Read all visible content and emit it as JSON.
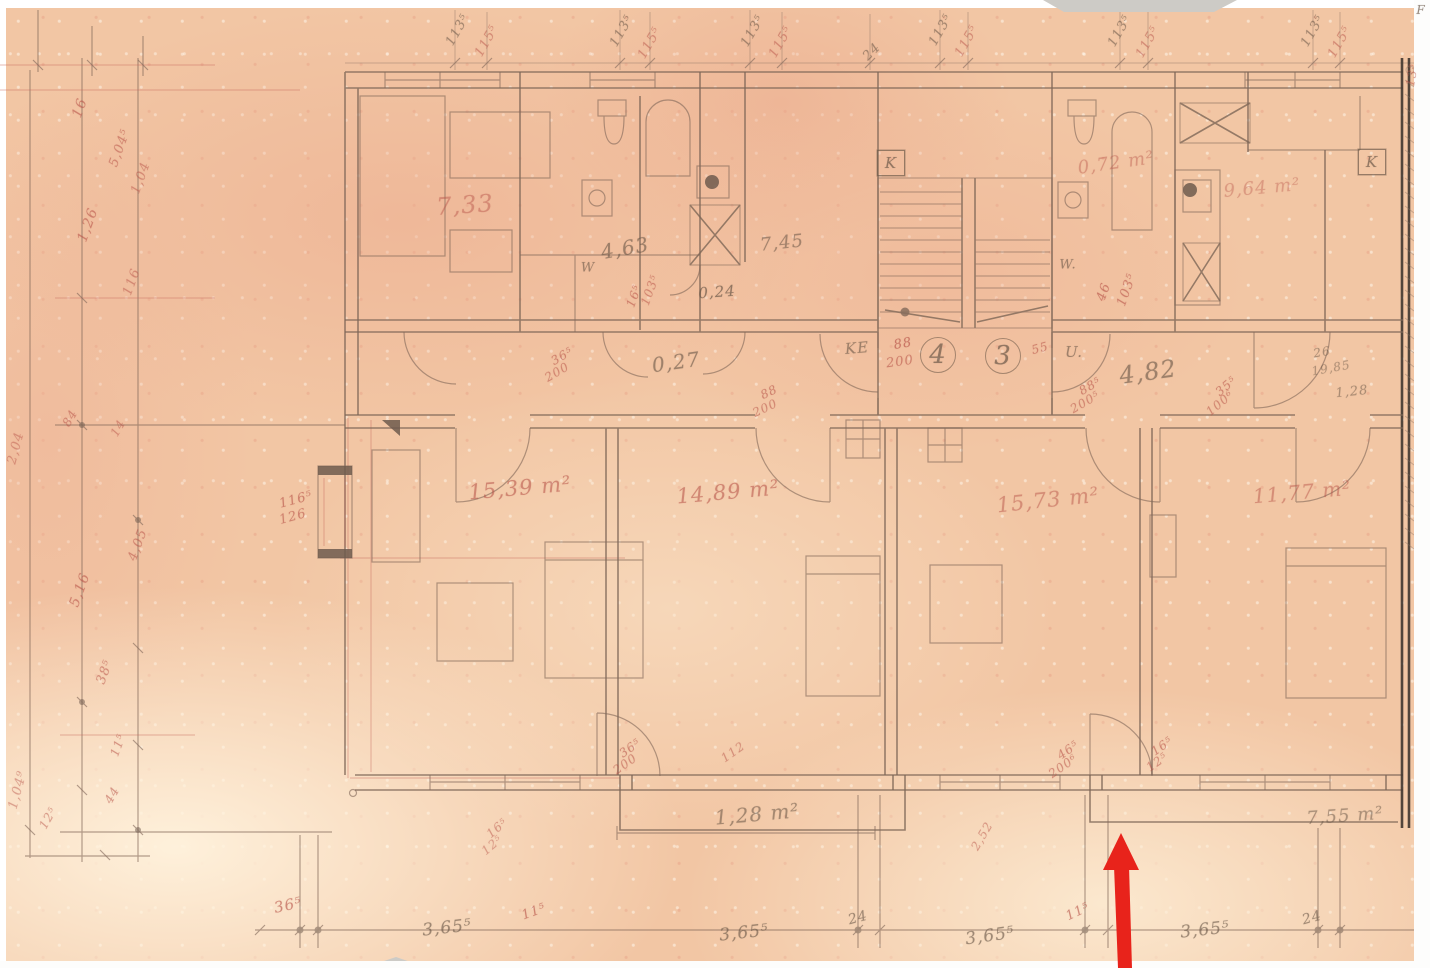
{
  "meta": {
    "kind": "scanned hand-drawn architectural floor plan",
    "paper_color": "#f2c6a4",
    "pencil_color": "#7e6757",
    "red_pencil_color": "#c05f55",
    "arrow_color": "#e8231b"
  },
  "annotations": [
    {
      "name": "room-area",
      "text": "7,33",
      "x": 465,
      "y": 205,
      "rot": -4,
      "size": 24,
      "color": "red",
      "opacity": 0.55
    },
    {
      "name": "room-area",
      "text": "0,72 m²",
      "x": 1116,
      "y": 163,
      "rot": -8,
      "size": 18,
      "color": "red",
      "opacity": 0.5
    },
    {
      "name": "room-area",
      "text": "9,64 m²",
      "x": 1262,
      "y": 188,
      "rot": -5,
      "size": 18,
      "color": "red",
      "opacity": 0.45
    },
    {
      "name": "room-area",
      "text": "4,63",
      "x": 625,
      "y": 248,
      "rot": -10,
      "size": 20,
      "color": "pencil",
      "opacity": 0.7
    },
    {
      "name": "room-area",
      "text": "7,45",
      "x": 782,
      "y": 243,
      "rot": -6,
      "size": 18,
      "color": "pencil",
      "opacity": 0.65
    },
    {
      "name": "room-area",
      "text": "0,24",
      "x": 717,
      "y": 292,
      "rot": -4,
      "size": 15,
      "color": "pencil",
      "opacity": 0.8
    },
    {
      "name": "room-area",
      "text": "0,27",
      "x": 676,
      "y": 362,
      "rot": -8,
      "size": 20,
      "color": "pencil",
      "opacity": 0.7
    },
    {
      "name": "room-area",
      "text": "15,39 m²",
      "x": 520,
      "y": 488,
      "rot": -5,
      "size": 21,
      "color": "red",
      "opacity": 0.68
    },
    {
      "name": "room-area",
      "text": "14,89 m²",
      "x": 728,
      "y": 492,
      "rot": -5,
      "size": 21,
      "color": "red",
      "opacity": 0.68
    },
    {
      "name": "room-area",
      "text": "15,73 m²",
      "x": 1048,
      "y": 500,
      "rot": -6,
      "size": 21,
      "color": "red",
      "opacity": 0.58
    },
    {
      "name": "room-area",
      "text": "11,77 m²",
      "x": 1302,
      "y": 492,
      "rot": -5,
      "size": 20,
      "color": "red",
      "opacity": 0.58
    },
    {
      "name": "room-area",
      "text": "1,28 m²",
      "x": 757,
      "y": 814,
      "rot": -5,
      "size": 20,
      "color": "pencil",
      "opacity": 0.66
    },
    {
      "name": "room-area",
      "text": "7,55 m²",
      "x": 1345,
      "y": 816,
      "rot": -4,
      "size": 18,
      "color": "pencil",
      "opacity": 0.6
    },
    {
      "name": "hall-dim",
      "text": "4,82",
      "x": 1148,
      "y": 372,
      "rot": -8,
      "size": 24,
      "color": "pencil",
      "opacity": 0.7
    },
    {
      "name": "label-ke",
      "text": "KE",
      "x": 857,
      "y": 348,
      "rot": -5,
      "size": 15,
      "color": "pencil",
      "opacity": 0.7
    },
    {
      "name": "label-u",
      "text": "U.",
      "x": 1074,
      "y": 352,
      "rot": 0,
      "size": 15,
      "color": "pencil",
      "opacity": 0.7
    },
    {
      "name": "label-w",
      "text": "W",
      "x": 588,
      "y": 268,
      "rot": 0,
      "size": 13,
      "color": "pencil",
      "opacity": 0.7
    },
    {
      "name": "label-w",
      "text": "W.",
      "x": 1068,
      "y": 265,
      "rot": 0,
      "size": 13,
      "color": "pencil",
      "opacity": 0.7
    },
    {
      "name": "unit-number",
      "text": "4",
      "x": 938,
      "y": 355,
      "rot": 0,
      "size": 26,
      "color": "pencil",
      "shape": "circle",
      "opacity": 0.8
    },
    {
      "name": "unit-number",
      "text": "3",
      "x": 1003,
      "y": 356,
      "rot": 0,
      "size": 26,
      "color": "pencil",
      "shape": "circle",
      "opacity": 0.8
    },
    {
      "name": "flue-k",
      "text": "K",
      "x": 891,
      "y": 163,
      "rot": 0,
      "size": 15,
      "color": "pencil",
      "shape": "box",
      "opacity": 0.8
    },
    {
      "name": "flue-k",
      "text": "K",
      "x": 1372,
      "y": 162,
      "rot": 0,
      "size": 15,
      "color": "pencil",
      "shape": "box",
      "opacity": 0.8
    },
    {
      "name": "label-f",
      "text": "F",
      "x": 1421,
      "y": 10,
      "rot": 0,
      "size": 12,
      "color": "pencil",
      "opacity": 0.8
    },
    {
      "name": "door-dim",
      "text": "88",
      "x": 903,
      "y": 344,
      "rot": -10,
      "size": 13,
      "color": "red",
      "opacity": 0.8
    },
    {
      "name": "door-dim",
      "text": "200",
      "x": 900,
      "y": 362,
      "rot": -8,
      "size": 13,
      "color": "red",
      "opacity": 0.7
    },
    {
      "name": "door-dim",
      "text": "55",
      "x": 1040,
      "y": 348,
      "rot": -15,
      "size": 12,
      "color": "red",
      "opacity": 0.7
    },
    {
      "name": "door-dim",
      "text": "36⁵",
      "x": 562,
      "y": 356,
      "rot": -30,
      "size": 12,
      "color": "red",
      "opacity": 0.7
    },
    {
      "name": "door-dim",
      "text": "200",
      "x": 557,
      "y": 372,
      "rot": -30,
      "size": 12,
      "color": "red",
      "opacity": 0.65
    },
    {
      "name": "door-dim",
      "text": "88",
      "x": 769,
      "y": 392,
      "rot": -25,
      "size": 12,
      "color": "red",
      "opacity": 0.7
    },
    {
      "name": "door-dim",
      "text": "200",
      "x": 765,
      "y": 408,
      "rot": -25,
      "size": 12,
      "color": "red",
      "opacity": 0.65
    },
    {
      "name": "door-dim",
      "text": "88⁵",
      "x": 1090,
      "y": 386,
      "rot": -30,
      "size": 12,
      "color": "red",
      "opacity": 0.7
    },
    {
      "name": "door-dim",
      "text": "200⁵",
      "x": 1085,
      "y": 402,
      "rot": -30,
      "size": 12,
      "color": "red",
      "opacity": 0.65
    },
    {
      "name": "door-dim",
      "text": "35⁵",
      "x": 1226,
      "y": 386,
      "rot": -40,
      "size": 12,
      "color": "red",
      "opacity": 0.7
    },
    {
      "name": "door-dim",
      "text": "100⁶",
      "x": 1220,
      "y": 403,
      "rot": -40,
      "size": 12,
      "color": "red",
      "opacity": 0.65
    },
    {
      "name": "door-dim",
      "text": "46",
      "x": 1104,
      "y": 292,
      "rot": -70,
      "size": 13,
      "color": "red",
      "opacity": 0.75
    },
    {
      "name": "door-dim",
      "text": "103⁵",
      "x": 1127,
      "y": 290,
      "rot": -70,
      "size": 13,
      "color": "red",
      "opacity": 0.7
    },
    {
      "name": "door-dim",
      "text": "16⁵",
      "x": 634,
      "y": 296,
      "rot": -70,
      "size": 12,
      "color": "red",
      "opacity": 0.7
    },
    {
      "name": "door-dim",
      "text": "103⁵",
      "x": 650,
      "y": 290,
      "rot": -70,
      "size": 12,
      "color": "red",
      "opacity": 0.65
    },
    {
      "name": "window-dim",
      "text": "116⁵",
      "x": 296,
      "y": 500,
      "rot": -15,
      "size": 13,
      "color": "red",
      "opacity": 0.75
    },
    {
      "name": "window-dim",
      "text": "126",
      "x": 293,
      "y": 517,
      "rot": -15,
      "size": 13,
      "color": "red",
      "opacity": 0.7
    },
    {
      "name": "door-dim",
      "text": "26",
      "x": 1322,
      "y": 352,
      "rot": -10,
      "size": 12,
      "color": "pencil",
      "opacity": 0.6
    },
    {
      "name": "door-dim",
      "text": "19,85",
      "x": 1331,
      "y": 368,
      "rot": -10,
      "size": 12,
      "color": "pencil",
      "opacity": 0.55
    },
    {
      "name": "door-dim",
      "text": "1,28",
      "x": 1352,
      "y": 392,
      "rot": -6,
      "size": 13,
      "color": "pencil",
      "opacity": 0.6
    },
    {
      "name": "door-dim",
      "text": "36⁵",
      "x": 630,
      "y": 748,
      "rot": -35,
      "size": 12,
      "color": "red",
      "opacity": 0.7
    },
    {
      "name": "door-dim",
      "text": "200",
      "x": 625,
      "y": 764,
      "rot": -35,
      "size": 12,
      "color": "red",
      "opacity": 0.65
    },
    {
      "name": "door-dim",
      "text": "112",
      "x": 733,
      "y": 752,
      "rot": -35,
      "size": 12,
      "color": "red",
      "opacity": 0.6
    },
    {
      "name": "door-dim",
      "text": "46⁵",
      "x": 1068,
      "y": 750,
      "rot": -35,
      "size": 12,
      "color": "red",
      "opacity": 0.7
    },
    {
      "name": "door-dim",
      "text": "200⁶",
      "x": 1063,
      "y": 766,
      "rot": -35,
      "size": 12,
      "color": "red",
      "opacity": 0.65
    },
    {
      "name": "door-dim",
      "text": "16⁵",
      "x": 1162,
      "y": 746,
      "rot": -35,
      "size": 12,
      "color": "red",
      "opacity": 0.7
    },
    {
      "name": "door-dim",
      "text": "12⁵",
      "x": 1157,
      "y": 762,
      "rot": -35,
      "size": 12,
      "color": "red",
      "opacity": 0.65
    },
    {
      "name": "door-dim",
      "text": "2,52",
      "x": 982,
      "y": 836,
      "rot": -60,
      "size": 12,
      "color": "red",
      "opacity": 0.6
    },
    {
      "name": "door-dim",
      "text": "16⁵",
      "x": 497,
      "y": 828,
      "rot": -40,
      "size": 12,
      "color": "red",
      "opacity": 0.6
    },
    {
      "name": "door-dim",
      "text": "12⁵",
      "x": 492,
      "y": 845,
      "rot": -40,
      "size": 12,
      "color": "red",
      "opacity": 0.55
    },
    {
      "name": "bottom-dim",
      "text": "36⁵",
      "x": 288,
      "y": 905,
      "rot": -12,
      "size": 15,
      "color": "red",
      "opacity": 0.75
    },
    {
      "name": "bottom-dim",
      "text": "3,65⁵",
      "x": 447,
      "y": 928,
      "rot": -6,
      "size": 17,
      "color": "pencil",
      "opacity": 0.72
    },
    {
      "name": "bottom-dim",
      "text": "11⁵",
      "x": 534,
      "y": 912,
      "rot": -20,
      "size": 13,
      "color": "red",
      "opacity": 0.75
    },
    {
      "name": "bottom-dim",
      "text": "3,65⁵",
      "x": 744,
      "y": 933,
      "rot": -6,
      "size": 17,
      "color": "pencil",
      "opacity": 0.72
    },
    {
      "name": "bottom-dim",
      "text": "24",
      "x": 858,
      "y": 918,
      "rot": -15,
      "size": 14,
      "color": "pencil",
      "opacity": 0.7
    },
    {
      "name": "bottom-dim",
      "text": "3,65⁵",
      "x": 990,
      "y": 936,
      "rot": -8,
      "size": 17,
      "color": "pencil",
      "opacity": 0.72
    },
    {
      "name": "bottom-dim",
      "text": "11⁵",
      "x": 1078,
      "y": 912,
      "rot": -25,
      "size": 13,
      "color": "red",
      "opacity": 0.75
    },
    {
      "name": "bottom-dim",
      "text": "3,65⁵",
      "x": 1205,
      "y": 930,
      "rot": -6,
      "size": 17,
      "color": "pencil",
      "opacity": 0.72
    },
    {
      "name": "bottom-dim",
      "text": "24",
      "x": 1312,
      "y": 918,
      "rot": -15,
      "size": 14,
      "color": "pencil",
      "opacity": 0.7
    },
    {
      "name": "top-dim",
      "text": "113⁵",
      "x": 458,
      "y": 30,
      "rot": -60,
      "size": 13,
      "color": "pencil",
      "opacity": 0.65
    },
    {
      "name": "top-dim",
      "text": "115⁵",
      "x": 487,
      "y": 41,
      "rot": -60,
      "size": 13,
      "color": "red",
      "opacity": 0.6
    },
    {
      "name": "top-dim",
      "text": "113⁵",
      "x": 622,
      "y": 31,
      "rot": -60,
      "size": 13,
      "color": "pencil",
      "opacity": 0.65
    },
    {
      "name": "top-dim",
      "text": "115⁵",
      "x": 650,
      "y": 43,
      "rot": -60,
      "size": 13,
      "color": "red",
      "opacity": 0.6
    },
    {
      "name": "top-dim",
      "text": "113⁵",
      "x": 753,
      "y": 31,
      "rot": -60,
      "size": 13,
      "color": "pencil",
      "opacity": 0.65
    },
    {
      "name": "top-dim",
      "text": "115⁵",
      "x": 781,
      "y": 42,
      "rot": -60,
      "size": 13,
      "color": "red",
      "opacity": 0.6
    },
    {
      "name": "top-dim",
      "text": "24",
      "x": 872,
      "y": 52,
      "rot": -45,
      "size": 13,
      "color": "pencil",
      "opacity": 0.65
    },
    {
      "name": "top-dim",
      "text": "113⁵",
      "x": 941,
      "y": 30,
      "rot": -60,
      "size": 13,
      "color": "pencil",
      "opacity": 0.65
    },
    {
      "name": "top-dim",
      "text": "115⁵",
      "x": 967,
      "y": 41,
      "rot": -60,
      "size": 13,
      "color": "red",
      "opacity": 0.6
    },
    {
      "name": "top-dim",
      "text": "113⁵",
      "x": 1120,
      "y": 31,
      "rot": -60,
      "size": 13,
      "color": "pencil",
      "opacity": 0.65
    },
    {
      "name": "top-dim",
      "text": "115⁵",
      "x": 1148,
      "y": 42,
      "rot": -60,
      "size": 13,
      "color": "red",
      "opacity": 0.6
    },
    {
      "name": "top-dim",
      "text": "113⁵",
      "x": 1313,
      "y": 31,
      "rot": -60,
      "size": 13,
      "color": "pencil",
      "opacity": 0.65
    },
    {
      "name": "top-dim",
      "text": "115⁵",
      "x": 1340,
      "y": 42,
      "rot": -60,
      "size": 13,
      "color": "red",
      "opacity": 0.6
    },
    {
      "name": "top-dim",
      "text": "13⁵",
      "x": 1412,
      "y": 75,
      "rot": -80,
      "size": 12,
      "color": "red",
      "opacity": 0.6
    },
    {
      "name": "left-dim",
      "text": "16",
      "x": 80,
      "y": 108,
      "rot": -70,
      "size": 14,
      "color": "red",
      "opacity": 0.7
    },
    {
      "name": "left-dim",
      "text": "5,04⁵",
      "x": 120,
      "y": 148,
      "rot": -70,
      "size": 13,
      "color": "red",
      "opacity": 0.65
    },
    {
      "name": "left-dim",
      "text": "1,26",
      "x": 88,
      "y": 225,
      "rot": -70,
      "size": 14,
      "color": "red",
      "opacity": 0.7
    },
    {
      "name": "left-dim",
      "text": "1,04",
      "x": 141,
      "y": 178,
      "rot": -70,
      "size": 13,
      "color": "red",
      "opacity": 0.6
    },
    {
      "name": "left-dim",
      "text": "116",
      "x": 132,
      "y": 282,
      "rot": -70,
      "size": 13,
      "color": "red",
      "opacity": 0.6
    },
    {
      "name": "left-dim",
      "text": "84",
      "x": 70,
      "y": 418,
      "rot": -60,
      "size": 12,
      "color": "red",
      "opacity": 0.65
    },
    {
      "name": "left-dim",
      "text": "14",
      "x": 118,
      "y": 428,
      "rot": -60,
      "size": 12,
      "color": "red",
      "opacity": 0.6
    },
    {
      "name": "left-dim",
      "text": "4,05",
      "x": 138,
      "y": 545,
      "rot": -70,
      "size": 13,
      "color": "red",
      "opacity": 0.65
    },
    {
      "name": "left-dim",
      "text": "5,16",
      "x": 80,
      "y": 590,
      "rot": -70,
      "size": 14,
      "color": "red",
      "opacity": 0.7
    },
    {
      "name": "left-dim",
      "text": "38⁵",
      "x": 105,
      "y": 672,
      "rot": -70,
      "size": 13,
      "color": "red",
      "opacity": 0.65
    },
    {
      "name": "left-dim",
      "text": "11⁵",
      "x": 118,
      "y": 745,
      "rot": -70,
      "size": 12,
      "color": "red",
      "opacity": 0.65
    },
    {
      "name": "left-dim",
      "text": "44",
      "x": 112,
      "y": 795,
      "rot": -60,
      "size": 12,
      "color": "red",
      "opacity": 0.65
    },
    {
      "name": "left-dim",
      "text": "12⁵",
      "x": 48,
      "y": 818,
      "rot": -60,
      "size": 12,
      "color": "red",
      "opacity": 0.6
    },
    {
      "name": "left-dim",
      "text": "2,04",
      "x": 16,
      "y": 448,
      "rot": -75,
      "size": 13,
      "color": "red",
      "opacity": 0.55
    },
    {
      "name": "left-dim",
      "text": "1,04⁹",
      "x": 18,
      "y": 790,
      "rot": -75,
      "size": 13,
      "color": "red",
      "opacity": 0.55
    }
  ]
}
